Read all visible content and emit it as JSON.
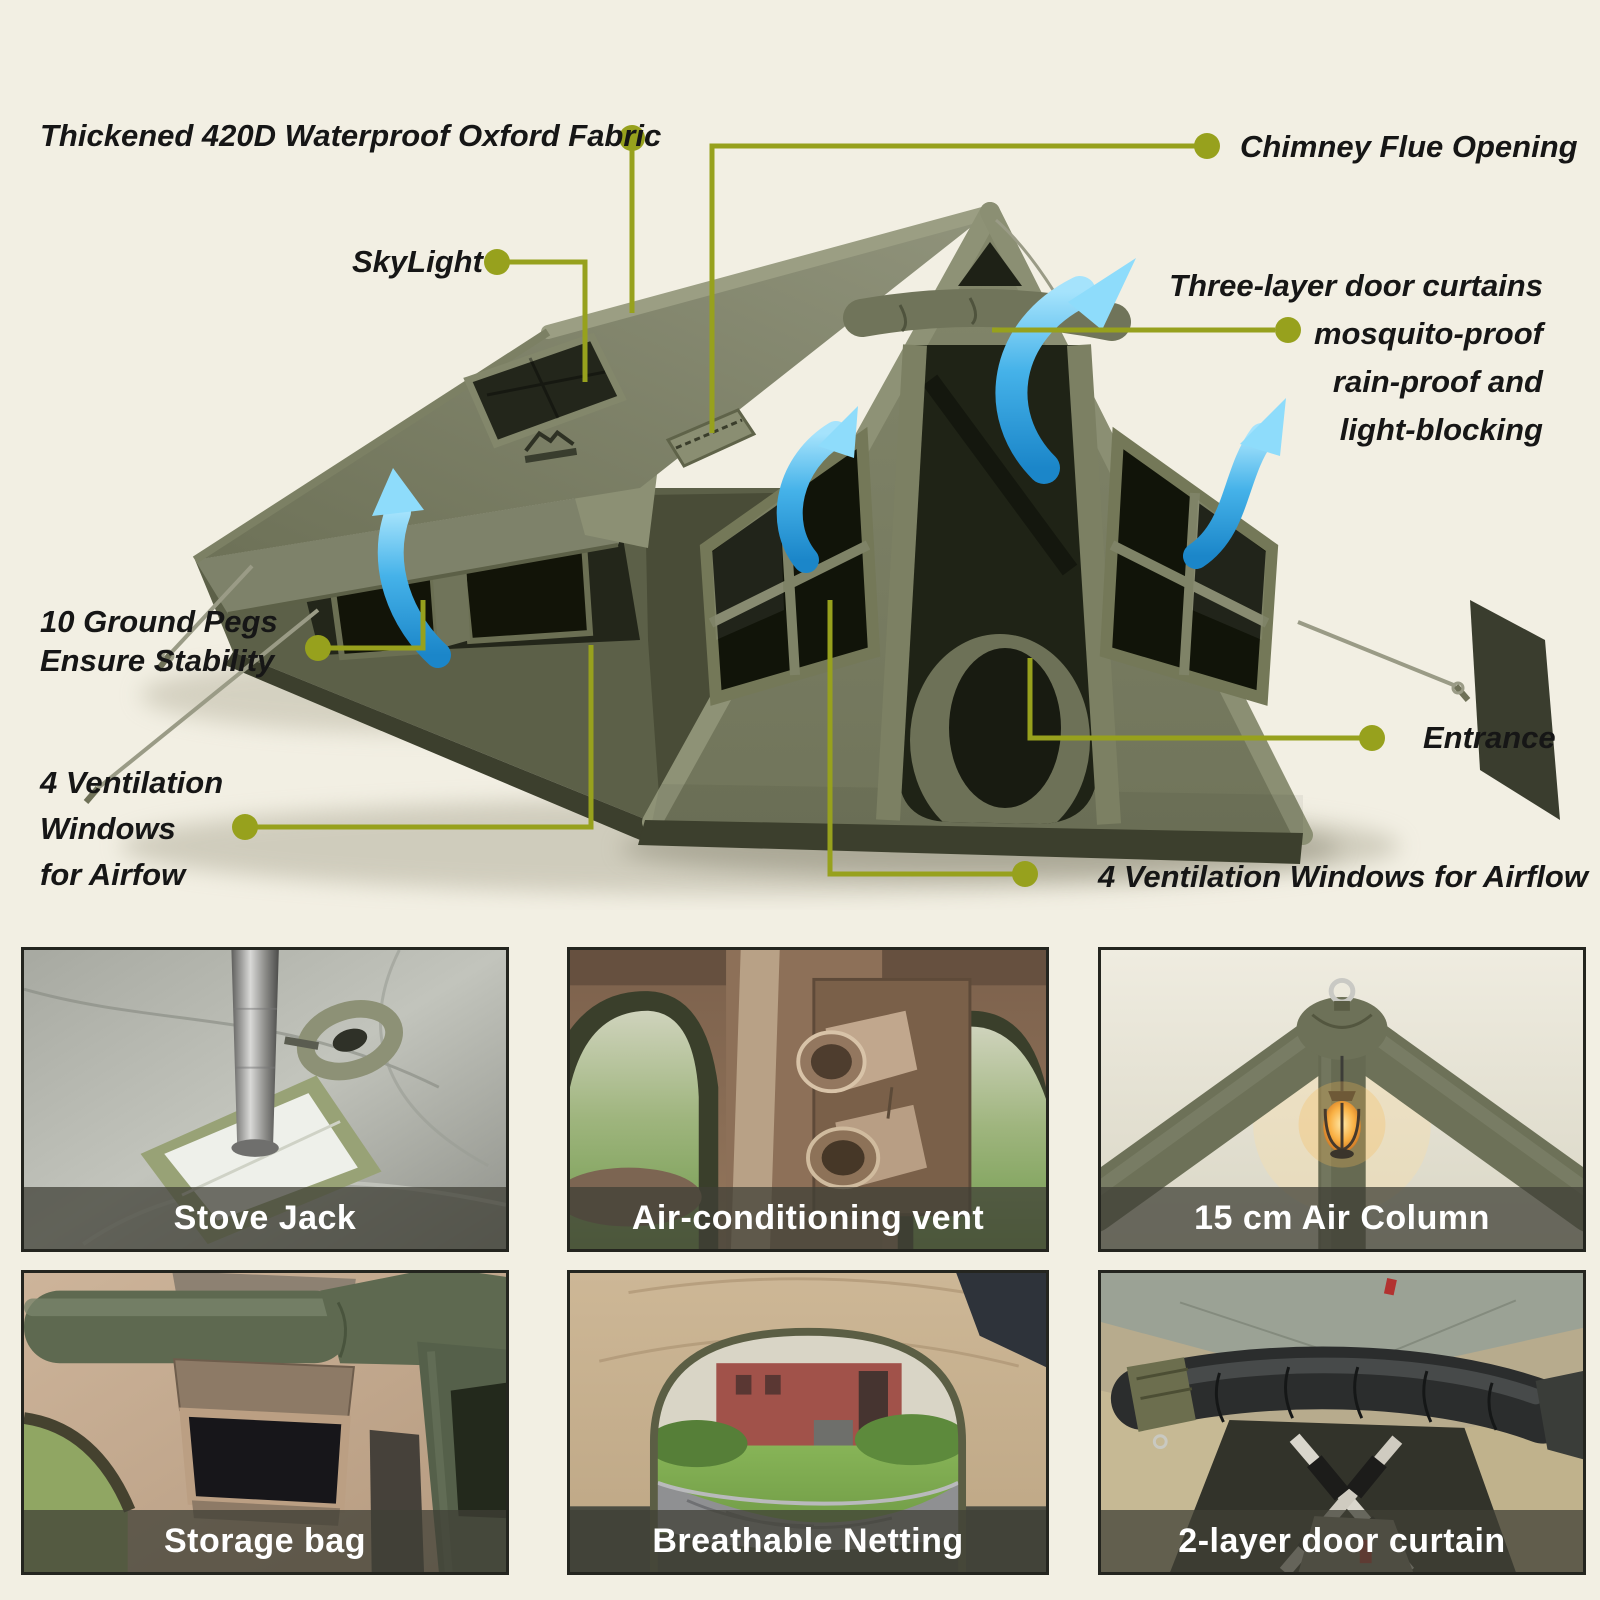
{
  "palette": {
    "background": "#f2efe3",
    "accent_callout": "#97a11d",
    "label_text": "#161616",
    "tent_olive": "#7b7f64",
    "arrow_blue": "#2d9fe0",
    "caption_bar": "rgba(63,64,54,0.74)",
    "caption_text": "#ffffff"
  },
  "callouts": {
    "fabric": {
      "text": "Thickened 420D Waterproof Oxford Fabric"
    },
    "chimney": {
      "text": "Chimney Flue Opening"
    },
    "skylight": {
      "text": "SkyLight"
    },
    "door_curtains": {
      "lines": [
        "Three-layer door curtains",
        "mosquito-proof",
        "rain-proof and",
        "light-blocking"
      ]
    },
    "ground_pegs": {
      "lines": [
        "10 Ground Pegs",
        "Ensure Stability"
      ]
    },
    "side_vents": {
      "lines": [
        "4 Ventilation",
        "Windows",
        "for Airfow"
      ]
    },
    "entrance": {
      "text": "Entrance"
    },
    "front_vents": {
      "text": "4 Ventilation Windows for Airflow"
    }
  },
  "features": [
    {
      "id": "stove-jack",
      "caption": "Stove Jack"
    },
    {
      "id": "ac-vent",
      "caption": "Air-conditioning vent"
    },
    {
      "id": "air-column",
      "caption": "15 cm Air Column"
    },
    {
      "id": "storage-bag",
      "caption": "Storage bag"
    },
    {
      "id": "breathable-netting",
      "caption": "Breathable Netting"
    },
    {
      "id": "door-curtain",
      "caption": "2-layer door curtain"
    }
  ]
}
